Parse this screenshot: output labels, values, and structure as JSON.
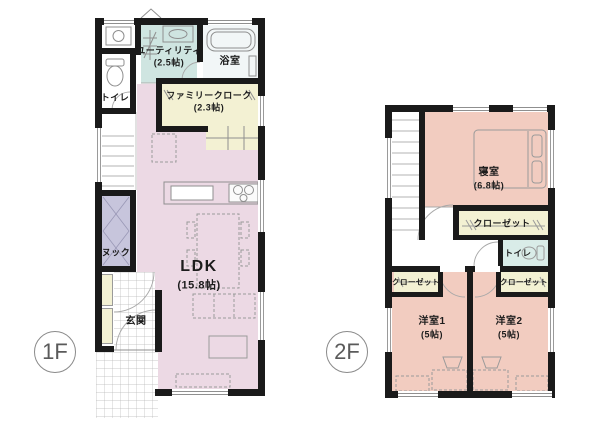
{
  "floors": {
    "f1": {
      "badge": "1F",
      "rooms": {
        "utility": {
          "name": "ユーティリティ",
          "size": "(2.5帖)"
        },
        "bath": {
          "name": "浴室"
        },
        "toilet": {
          "name": "トイレ"
        },
        "cloak": {
          "name": "ファミリークローク",
          "size": "(2.3帖)"
        },
        "nook": {
          "name": "ヌック"
        },
        "ldk": {
          "name": "LDK",
          "size": "(15.8帖)"
        },
        "genkan": {
          "name": "玄関"
        }
      }
    },
    "f2": {
      "badge": "2F",
      "rooms": {
        "bedroom": {
          "name": "寝室",
          "size": "(6.8帖)"
        },
        "closet_bedroom": {
          "name": "クローゼット"
        },
        "toilet": {
          "name": "トイレ"
        },
        "closet_room1": {
          "name": "クローゼット"
        },
        "closet_room2": {
          "name": "クローゼット"
        },
        "room1": {
          "name": "洋室1",
          "size": "(5帖)"
        },
        "room2": {
          "name": "洋室2",
          "size": "(5帖)"
        }
      }
    }
  },
  "colors": {
    "wall": "#1a1a1a",
    "ldk_pink": "#ecd9e4",
    "room_salmon": "#f2ccc0",
    "utility_teal": "#cfe5e1",
    "closet_cream": "#f3f1d3",
    "nook_lavender": "#c7c5dc",
    "toilet_teal": "#d9ece8",
    "bath_gray": "#f2f6f7",
    "white": "#ffffff",
    "line_gray": "#8f8f8f"
  }
}
